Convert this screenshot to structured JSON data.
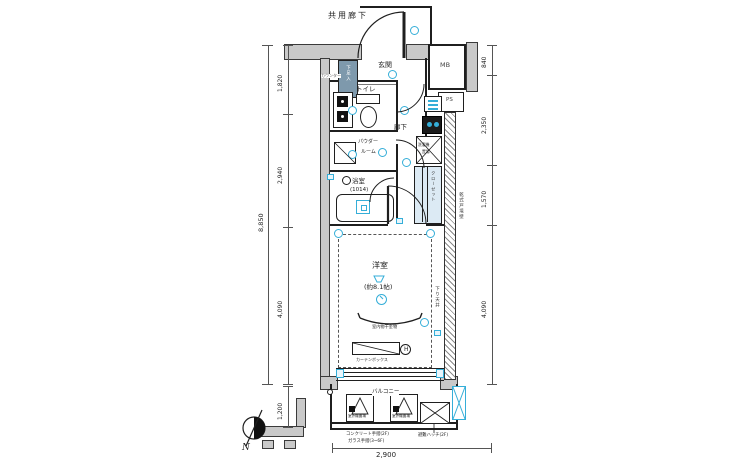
{
  "colors": {
    "accent_cyan": "#35aed8",
    "wall_gray": "#c9c9c9",
    "line_black": "#1f1f1f",
    "closet_fill": "#dceaf4"
  },
  "labels": {
    "common_corridor": "共用廊下",
    "entrance": "玄関",
    "meter_box": "MB",
    "pipe_space": "PS",
    "shoe_cabinet": "下足入",
    "counter": "カウンター",
    "toilet": "トイレ",
    "powder_room_1": "パウダー",
    "powder_room_2": "ルーム",
    "hallway": "廊下",
    "bathroom": "浴室",
    "bathroom_size": "(1014)",
    "washer_1": "洗濯機",
    "washer_2": "置場",
    "closet": "クローゼット",
    "lowered_ceiling": "下り天井",
    "party_wall": "乾式戸境壁",
    "main_room": "洋室",
    "main_room_size": "(約8.1帖)",
    "indoor_laundry_hw": "室内物干金物",
    "curtain_box": "カーテンボックス",
    "hoscreen_mark": "H",
    "balcony": "バルコニー",
    "outdoor_unit": "室外機置場",
    "rail_concrete": "コンクリート手摺(2F)",
    "rail_glass": "ガラス手摺(3~6F)",
    "evac_hatch": "避難ハッチ(2F)",
    "north_mark": "N"
  },
  "dims": {
    "total_height": "8,850",
    "left_segments": [
      "1,820",
      "2,940",
      "4,090"
    ],
    "balcony_depth": "1,200",
    "right_segments": [
      "840",
      "2,350",
      "1,570",
      "4,090"
    ],
    "bottom_width": "2,900"
  }
}
